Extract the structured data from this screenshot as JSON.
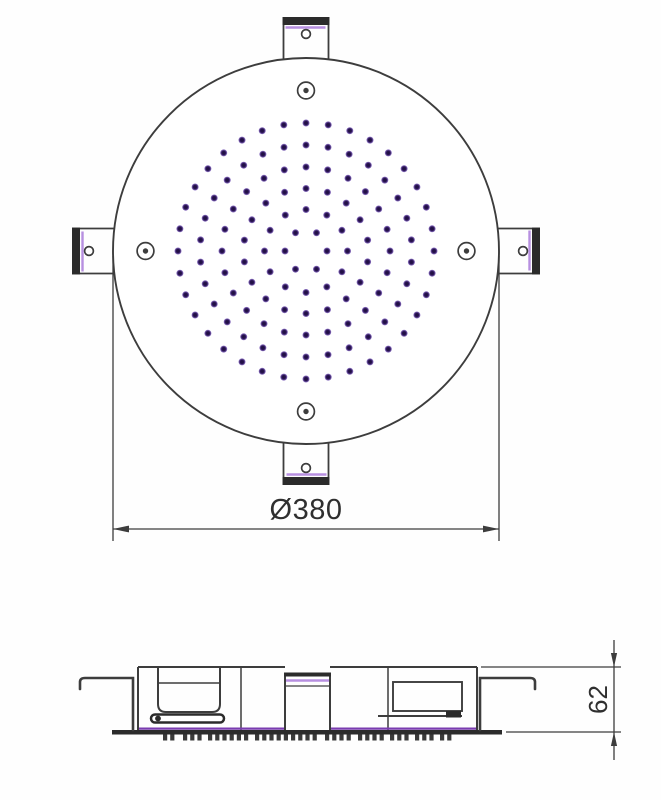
{
  "labels": {
    "diameter": "Ø380",
    "height": "62"
  },
  "colors": {
    "background": "#fefefe",
    "line": "#3d3d3d",
    "dark": "#2b2b2b",
    "accent_light": "#b78fe0",
    "accent_strong": "#7a3cb0",
    "dot_core": "#1d0e3c",
    "dot_mid": "#2a1454",
    "dot_halo": "#9a7fd2",
    "text": "#2f2f2f"
  },
  "top_view": {
    "cx": 306,
    "cy": 251,
    "radius": 193,
    "tab": {
      "half_width": 22.5,
      "outer_y": 17,
      "inner_y": 60,
      "bar_h": 8,
      "accent_y": 27.5,
      "hole_y": 34,
      "hole_r": 4.4,
      "names": [
        "mounting-tab-top",
        "mounting-tab-right",
        "mounting-tab-bottom",
        "mounting-tab-left"
      ]
    },
    "screw": {
      "offset": 160.5,
      "outer_r": 8.4,
      "inner_r": 2.7,
      "names": [
        "screw-hole-top",
        "screw-hole-right",
        "screw-hole-bottom",
        "screw-hole-left"
      ]
    },
    "nozzle_rings": [
      {
        "r": 21,
        "n": 6,
        "offset": 0
      },
      {
        "r": 41.5,
        "n": 12,
        "offset": 90
      },
      {
        "r": 62.5,
        "n": 18,
        "offset": 90
      },
      {
        "r": 84,
        "n": 24,
        "offset": 90
      },
      {
        "r": 106,
        "n": 30,
        "offset": 90
      },
      {
        "r": 128,
        "n": 36,
        "offset": 90
      }
    ],
    "dot_r": 3.5,
    "dim": {
      "ext_x1": 113,
      "ext_x2": 499,
      "ext_y_top": 256,
      "ext_y_bot": 541,
      "line_y": 529,
      "arrow_len": 16,
      "arrow_hw": 3.4,
      "text_x": 306,
      "text_y": 519,
      "font_size": 29
    }
  },
  "side_view": {
    "body": {
      "left": 138,
      "right": 477,
      "top": 667,
      "bottom": 730
    },
    "top_segments": [
      [
        138,
        285
      ],
      [
        330,
        477
      ]
    ],
    "dividers": [
      241,
      388
    ],
    "plate": {
      "left": 112,
      "right": 502,
      "top": 730,
      "h": 4.5
    },
    "plate_accent": {
      "y": 728.6,
      "segments": [
        [
          139,
          284
        ],
        [
          331,
          476
        ]
      ]
    },
    "pipe": {
      "left": 285,
      "right": 330,
      "cap_y": 672.5,
      "cap_h": 4,
      "accent_y": 680.5,
      "inner_line_y": 686
    },
    "pocket": {
      "left": 158,
      "right": 220,
      "top": 667,
      "bottom": 712,
      "corner": 8,
      "inner_line_y": 683
    },
    "slot": {
      "x": 151,
      "y": 714.5,
      "w": 73,
      "h": 8,
      "rx": 4,
      "nib_cx": 158,
      "nib_cy": 718.5,
      "nib_r": 2.9
    },
    "bracket": {
      "x": 393,
      "y": 682,
      "w": 69,
      "h": 29,
      "lower_line_y": 716,
      "lower_line_x1": 378,
      "foot_x": 446,
      "foot_w": 15,
      "foot_h": 6.5
    },
    "hooks": {
      "left": {
        "outer_x": 80,
        "inner_x": 133,
        "arm_y": 678,
        "drop_y": 689
      },
      "right": {
        "outer_x": 535,
        "inner_x": 480,
        "arm_y": 678,
        "drop_y": 689
      }
    },
    "teeth": {
      "y": 734.5,
      "w": 4.2,
      "h": 6,
      "pitch": 7.2,
      "clusters": [
        {
          "x": 163,
          "n": 2
        },
        {
          "x": 183,
          "n": 3
        },
        {
          "x": 208,
          "n": 6
        },
        {
          "x": 255,
          "n": 9
        },
        {
          "x": 325,
          "n": 4
        },
        {
          "x": 358,
          "n": 4
        },
        {
          "x": 390,
          "n": 3
        },
        {
          "x": 415,
          "n": 3
        },
        {
          "x": 440,
          "n": 2
        }
      ]
    },
    "dim": {
      "ext_top_y": 667,
      "ext_bot_y": 732,
      "ext_x1_top": 481,
      "ext_x1_bot": 506,
      "ext_x2": 621,
      "line_x": 614,
      "line_y1": 640,
      "line_y2": 760,
      "arrow_len": 14,
      "arrow_hw": 3.1,
      "text_x": 598,
      "text_y": 699.5,
      "font_size": 26
    }
  }
}
